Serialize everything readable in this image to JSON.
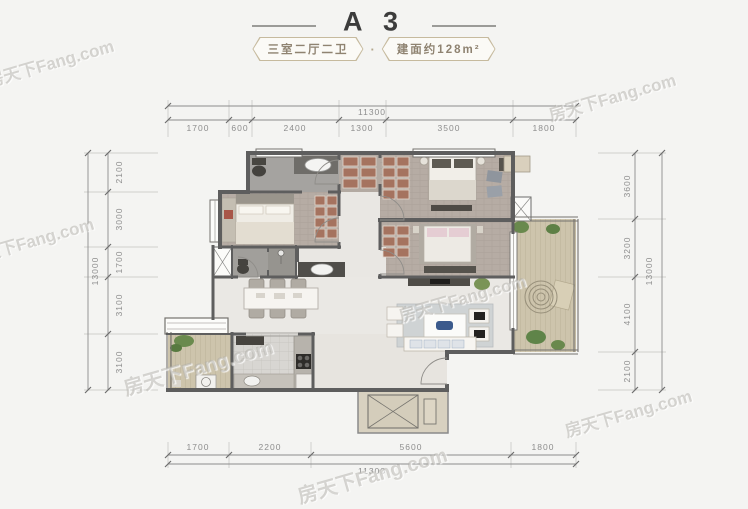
{
  "header": {
    "title": "A 3",
    "badge_left": "三室二厅二卫",
    "separator": "·",
    "badge_right": "建面约128m²"
  },
  "watermark": {
    "text": "房天下Fang.com"
  },
  "dimensions": {
    "top": {
      "total": "11300",
      "segments": [
        "1700",
        "600",
        "2400",
        "1300",
        "3500",
        "1800"
      ]
    },
    "bottom": {
      "total": "11300",
      "segments": [
        "1700",
        "2200",
        "5600",
        "1800"
      ]
    },
    "left": {
      "total": "13000",
      "segments": [
        "2100",
        "3000",
        "1700",
        "3100",
        "3100"
      ]
    },
    "right": {
      "total": "13000",
      "segments": [
        "3600",
        "3200",
        "4100",
        "2100"
      ]
    }
  },
  "colors": {
    "background": "#f4f4f2",
    "wall": "#5e5e5e",
    "wood_floor": "#b6aca4",
    "marble_floor": "#eae8e4",
    "deck_floor": "#cdc4ac",
    "tile_floor": "#d8d6d2",
    "bath_floor": "#a19f9b",
    "wardrobe_hatch": "#a5735f",
    "plant": "#69894d",
    "badge_border": "#c6ba9e",
    "badge_text": "#8f8371",
    "dim_text": "#8d8d8d"
  }
}
